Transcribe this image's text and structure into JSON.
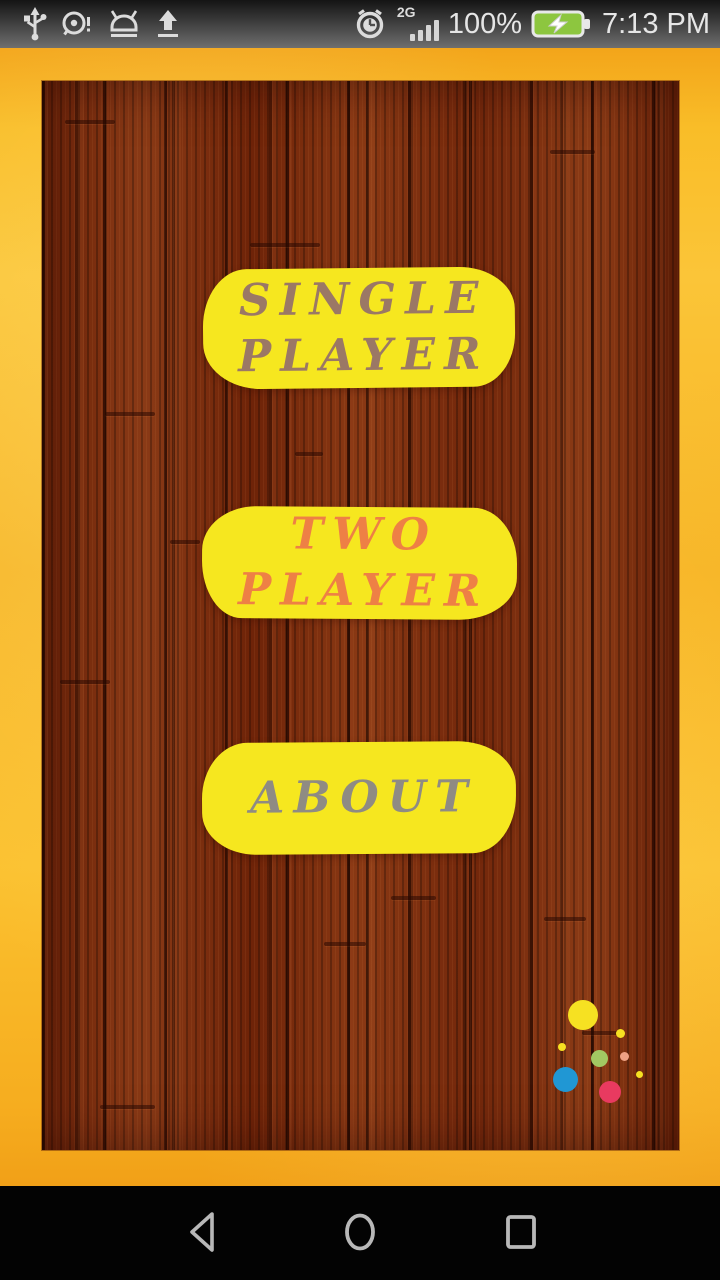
{
  "status_bar": {
    "left_icons": [
      "usb-icon",
      "alert-icon",
      "android-debug-icon",
      "upload-icon"
    ],
    "network_label": "2G",
    "battery_percent": "100%",
    "battery_color": "#8dc63f",
    "time": "7:13 PM"
  },
  "menu": {
    "button_color": "#f6e71f",
    "buttons": [
      {
        "id": "single-player",
        "line1": "SINGLE",
        "line2": "PLAYER",
        "text_color": "#9b7865"
      },
      {
        "id": "two-player",
        "line1": "TWO",
        "line2": "PLAYER",
        "text_color": "#ee8045"
      },
      {
        "id": "about",
        "line1": "ABOUT",
        "line2": "",
        "text_color": "#8f8b83"
      }
    ]
  },
  "decor_dots": [
    {
      "color": "#f6e122",
      "cx": 583,
      "cy": 1015,
      "d": 30
    },
    {
      "color": "#f6e122",
      "cx": 620,
      "cy": 1033,
      "d": 9
    },
    {
      "color": "#f6e122",
      "cx": 562,
      "cy": 1047,
      "d": 8
    },
    {
      "color": "#a2c862",
      "cx": 599,
      "cy": 1058,
      "d": 17
    },
    {
      "color": "#eea183",
      "cx": 624,
      "cy": 1056,
      "d": 9
    },
    {
      "color": "#f6e122",
      "cx": 639,
      "cy": 1074,
      "d": 7
    },
    {
      "color": "#2097d4",
      "cx": 565,
      "cy": 1079,
      "d": 25
    },
    {
      "color": "#e83a60",
      "cx": 610,
      "cy": 1092,
      "d": 22
    }
  ],
  "nav_bar": {
    "icons": [
      "back-icon",
      "home-icon",
      "recents-icon"
    ]
  }
}
